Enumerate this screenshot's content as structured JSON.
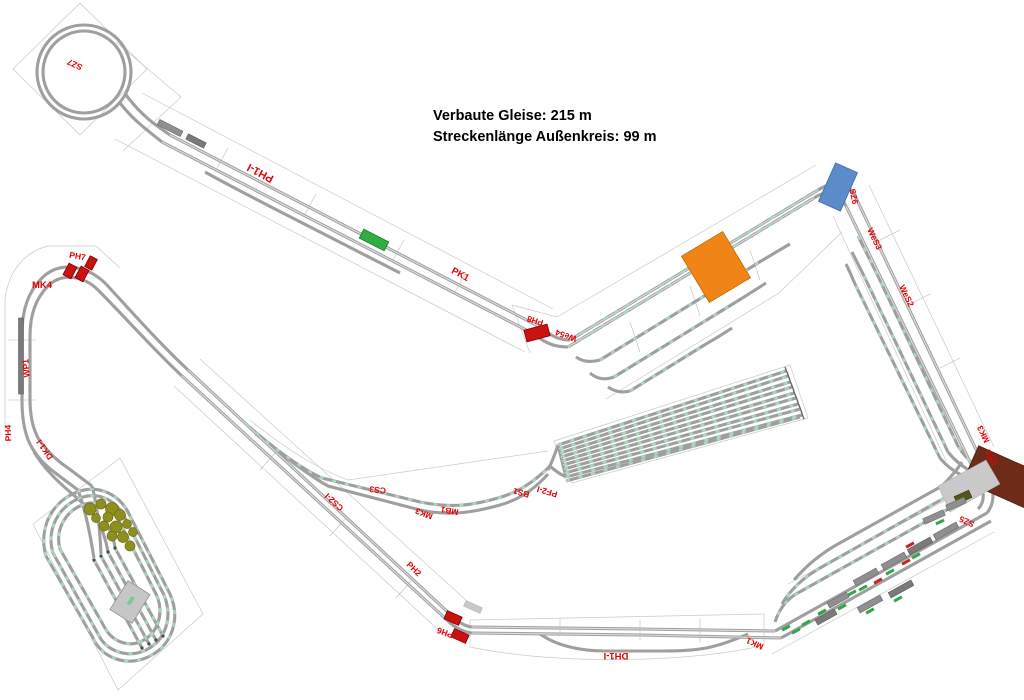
{
  "title": {
    "line1": "Verbaute Gleise: 215 m",
    "line2": "Streckenlänge Außenkreis: 99 m"
  },
  "stats": {
    "verbaute_gleise_m": 215,
    "streckenlaenge_aussenkreis_m": 99
  },
  "colors": {
    "background": "#ffffff",
    "track_gray": "#9f9f9f",
    "outline_gray": "#c9c9c9",
    "label_red": "#e60000",
    "tie_green": "#a9d9bd",
    "bridge_blue": "#5b8bc9",
    "building_orange": "#f08416",
    "building_red": "#cc1111",
    "portal_brown": "#6e2c18",
    "trees_olive": "#8f8f1f",
    "signal_green": "#2fae42",
    "shed_gray": "#c6c6c6",
    "train_green_tag": "#2fa64a",
    "train_red_tag": "#cc2222"
  },
  "labels": [
    {
      "id": "sz7",
      "text": "SZ7"
    },
    {
      "id": "ph1-i",
      "text": "PH1-I"
    },
    {
      "id": "pk1",
      "text": "PK1"
    },
    {
      "id": "ph8",
      "text": "PH8"
    },
    {
      "id": "we54",
      "text": "We54"
    },
    {
      "id": "sz6",
      "text": "SZ6"
    },
    {
      "id": "wes3",
      "text": "WeS3"
    },
    {
      "id": "wes2",
      "text": "WeS2"
    },
    {
      "id": "mk3-right",
      "text": "MK3"
    },
    {
      "id": "cs1",
      "text": "CS1"
    },
    {
      "id": "sz5",
      "text": "SZ5"
    },
    {
      "id": "mk1",
      "text": "MK1"
    },
    {
      "id": "dh1-i",
      "text": "DH1-I"
    },
    {
      "id": "ph6",
      "text": "PH6"
    },
    {
      "id": "ph2",
      "text": "PH2"
    },
    {
      "id": "cs2-i",
      "text": "CS2-I"
    },
    {
      "id": "cs3",
      "text": "CS3"
    },
    {
      "id": "mk3-left",
      "text": "MK3"
    },
    {
      "id": "mb1",
      "text": "MB1"
    },
    {
      "id": "bs1",
      "text": "BS1"
    },
    {
      "id": "pf2-i",
      "text": "PF2-I"
    },
    {
      "id": "mk4",
      "text": "MK4"
    },
    {
      "id": "ph7",
      "text": "PH7"
    },
    {
      "id": "wp1",
      "text": "WP1"
    },
    {
      "id": "ph4",
      "text": "PH4"
    },
    {
      "id": "dk1-i",
      "text": "DK1-I"
    }
  ]
}
